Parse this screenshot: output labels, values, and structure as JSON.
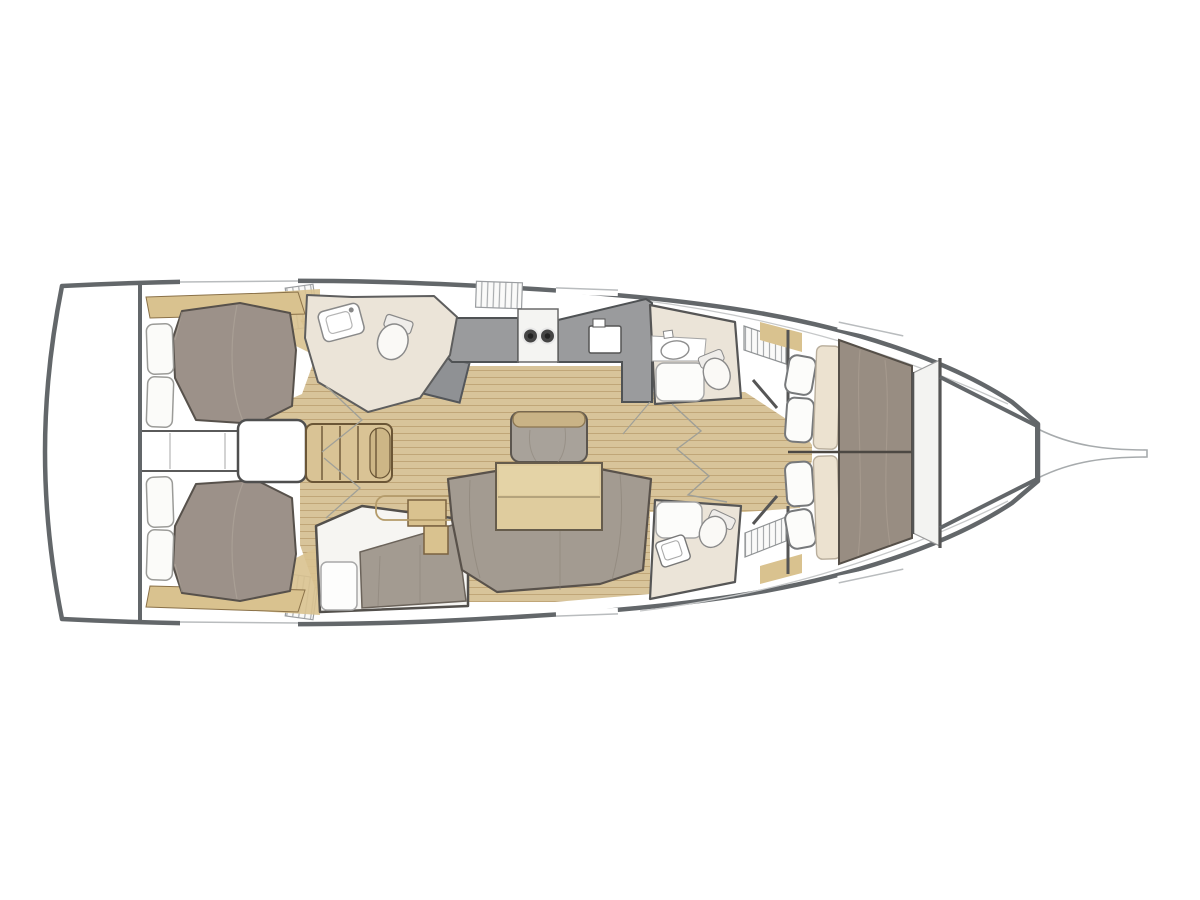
{
  "canvas": {
    "width": 1200,
    "height": 900,
    "background": "#ffffff"
  },
  "diagram": {
    "type": "yacht-floor-plan",
    "orientation": "bow-right",
    "areas": [
      "swim-platform-transom",
      "aft-cabin-port",
      "aft-cabin-starboard",
      "companionway-steps",
      "engine-box",
      "aft-head-port",
      "aft-compartment-starboard",
      "nav-station",
      "galley",
      "saloon-floor",
      "saloon-settee",
      "saloon-table",
      "saloon-sofa",
      "fore-head-port",
      "fore-head-starboard",
      "owner-cabin-forward",
      "anchor-locker",
      "bowsprit"
    ]
  },
  "palette": {
    "white": "#ffffff",
    "hull": "#63676a",
    "deck-line": "#c6c8c9",
    "floor": "#d8c49a",
    "floor-line": "#c0a678",
    "wood": "#d9c28f",
    "wood-line": "#8a7148",
    "steps": "#d9c395",
    "bed": "#9c9189",
    "bed2": "#988d82",
    "bed-line": "#57514b",
    "pillow": "#fbfbf9",
    "pillow2": "#ece2d0",
    "cream": "#ebe4d8",
    "counter": "#9a9b9d",
    "counter2": "#8f9194",
    "sofa": "#a39b91",
    "settee-back": "#c9b386",
    "table": "#dfcc9e"
  }
}
